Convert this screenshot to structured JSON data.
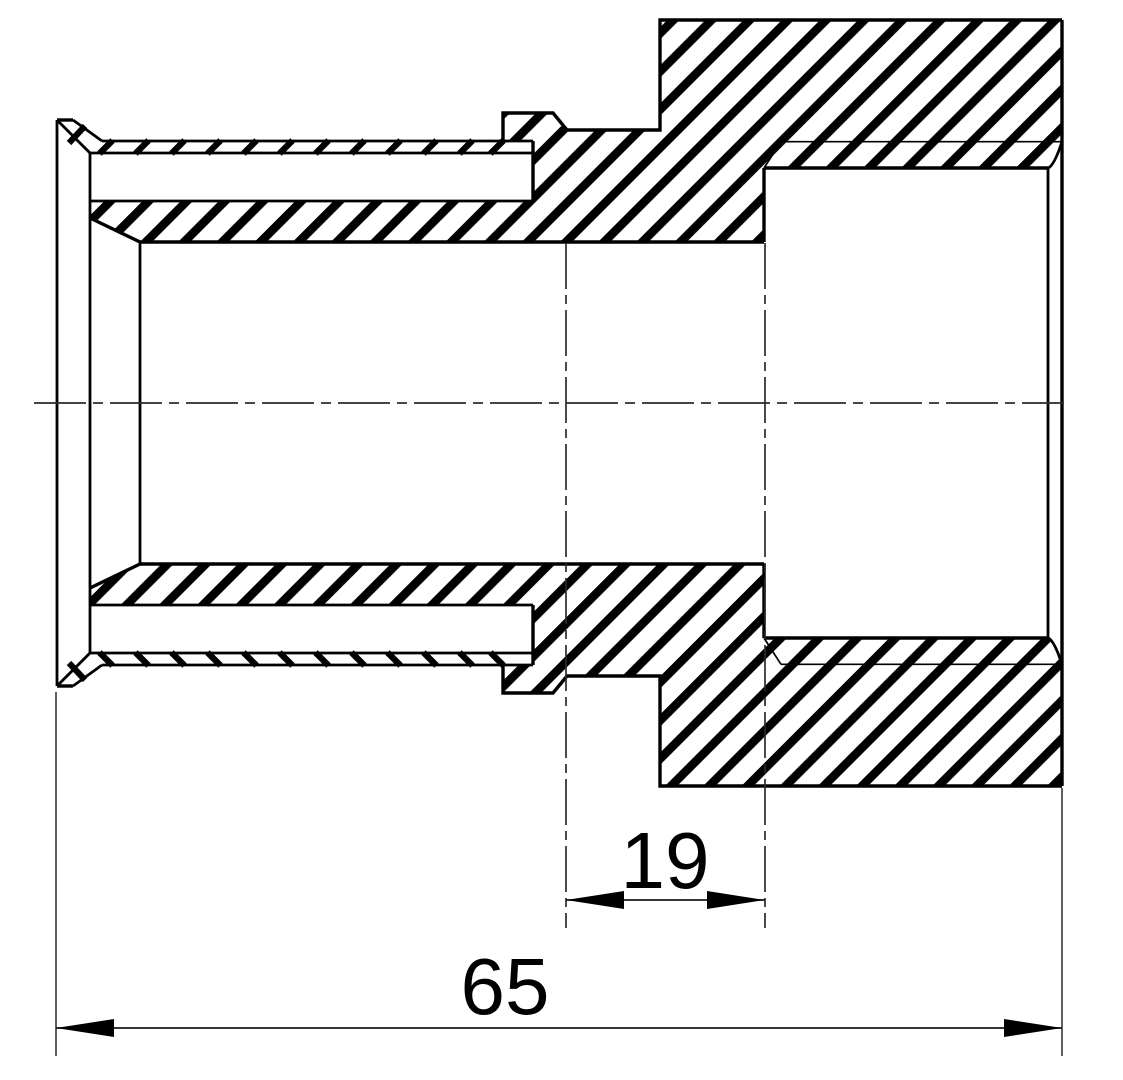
{
  "drawing": {
    "view": "cross-section",
    "dimensions": {
      "insertion_depth": {
        "value": "19"
      },
      "overall_length": {
        "value": "65"
      }
    },
    "style": {
      "line_color": "#000000",
      "thin_line_color": "#2b2b2b",
      "background": "#ffffff"
    }
  }
}
